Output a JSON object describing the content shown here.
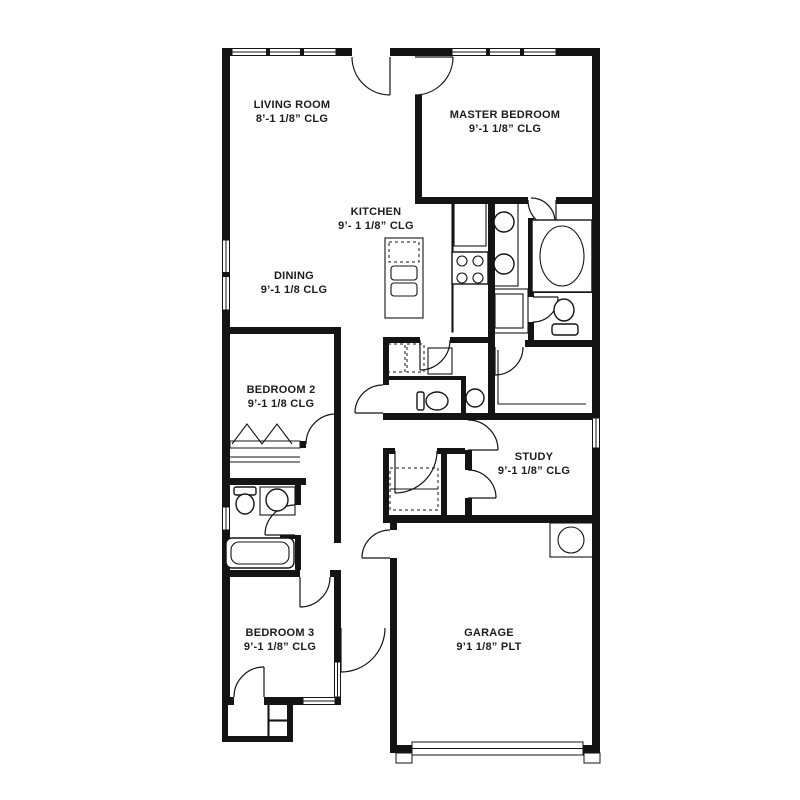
{
  "plan": {
    "background_color": "#ffffff",
    "wall_color": "#141414",
    "rooms": {
      "living": {
        "name": "LIVING ROOM",
        "ceiling": "8’-1 1/8” CLG"
      },
      "master": {
        "name": "MASTER BEDROOM",
        "ceiling": "9’-1 1/8” CLG"
      },
      "kitchen": {
        "name": "KITCHEN",
        "ceiling": "9’- 1 1/8” CLG"
      },
      "dining": {
        "name": "DINING",
        "ceiling": "9’-1 1/8 CLG"
      },
      "bedroom2": {
        "name": "BEDROOM 2",
        "ceiling": "9’-1 1/8 CLG"
      },
      "study": {
        "name": "STUDY",
        "ceiling": "9’-1 1/8” CLG"
      },
      "bedroom3": {
        "name": "BEDROOM 3",
        "ceiling": "9’-1 1/8” CLG"
      },
      "garage": {
        "name": "GARAGE",
        "ceiling": "9’1 1/8” PLT"
      }
    },
    "fixtures": [
      "kitchen-island",
      "dishwasher",
      "kitchen-sink",
      "range-cooktop",
      "refrigerator",
      "double-vanity-sinks",
      "bathtub",
      "shower",
      "toilet",
      "powder-sink",
      "washer-dryer",
      "water-heater",
      "closet-shelves",
      "bifold-doors",
      "garage-door",
      "front-door"
    ]
  }
}
